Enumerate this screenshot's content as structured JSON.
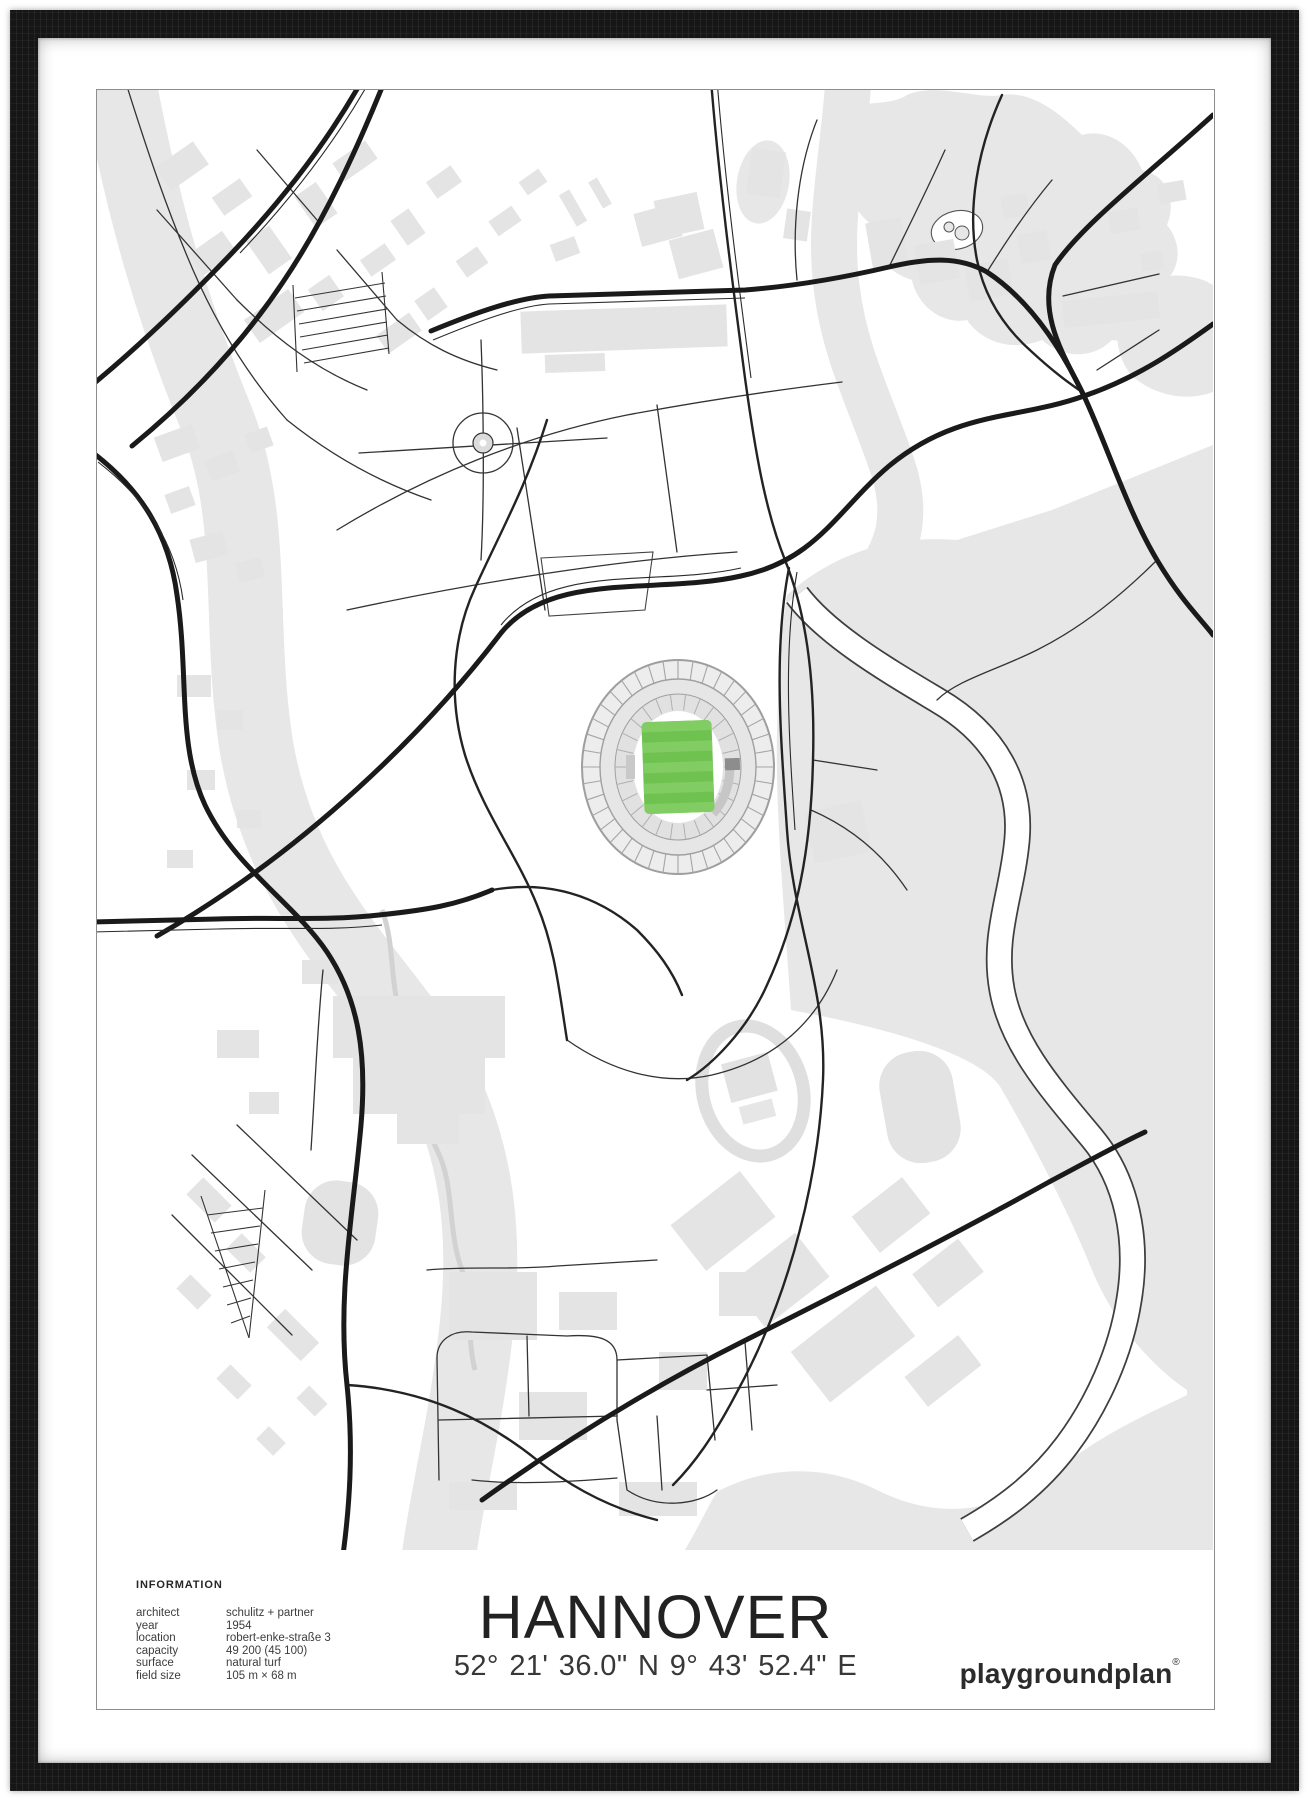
{
  "poster": {
    "title": "HANNOVER",
    "coordinates": "52° 21' 36.0\" N  9° 43' 52.4\" E",
    "brand": "playgroundplan",
    "brand_mark": "®",
    "info": {
      "heading": "INFORMATION",
      "rows": [
        {
          "label": "architect",
          "value": "schulitz + partner"
        },
        {
          "label": "year",
          "value": "1954"
        },
        {
          "label": "location",
          "value": "robert-enke-straße 3"
        },
        {
          "label": "capacity",
          "value": "49 200 (45 100)"
        },
        {
          "label": "surface",
          "value": "natural turf"
        },
        {
          "label": "field size",
          "value": "105 m × 68 m"
        }
      ]
    }
  },
  "colors": {
    "frame-black": "#161616",
    "map-gray": "#e7e7e7",
    "building-gray": "#e4e4e4",
    "road-black": "#1a1a1a",
    "stadium-gray": "#ededed",
    "pitch-green": "#6fc24f",
    "pitch-stripe": "#81cd63",
    "text-dark": "#2e2e2e"
  }
}
